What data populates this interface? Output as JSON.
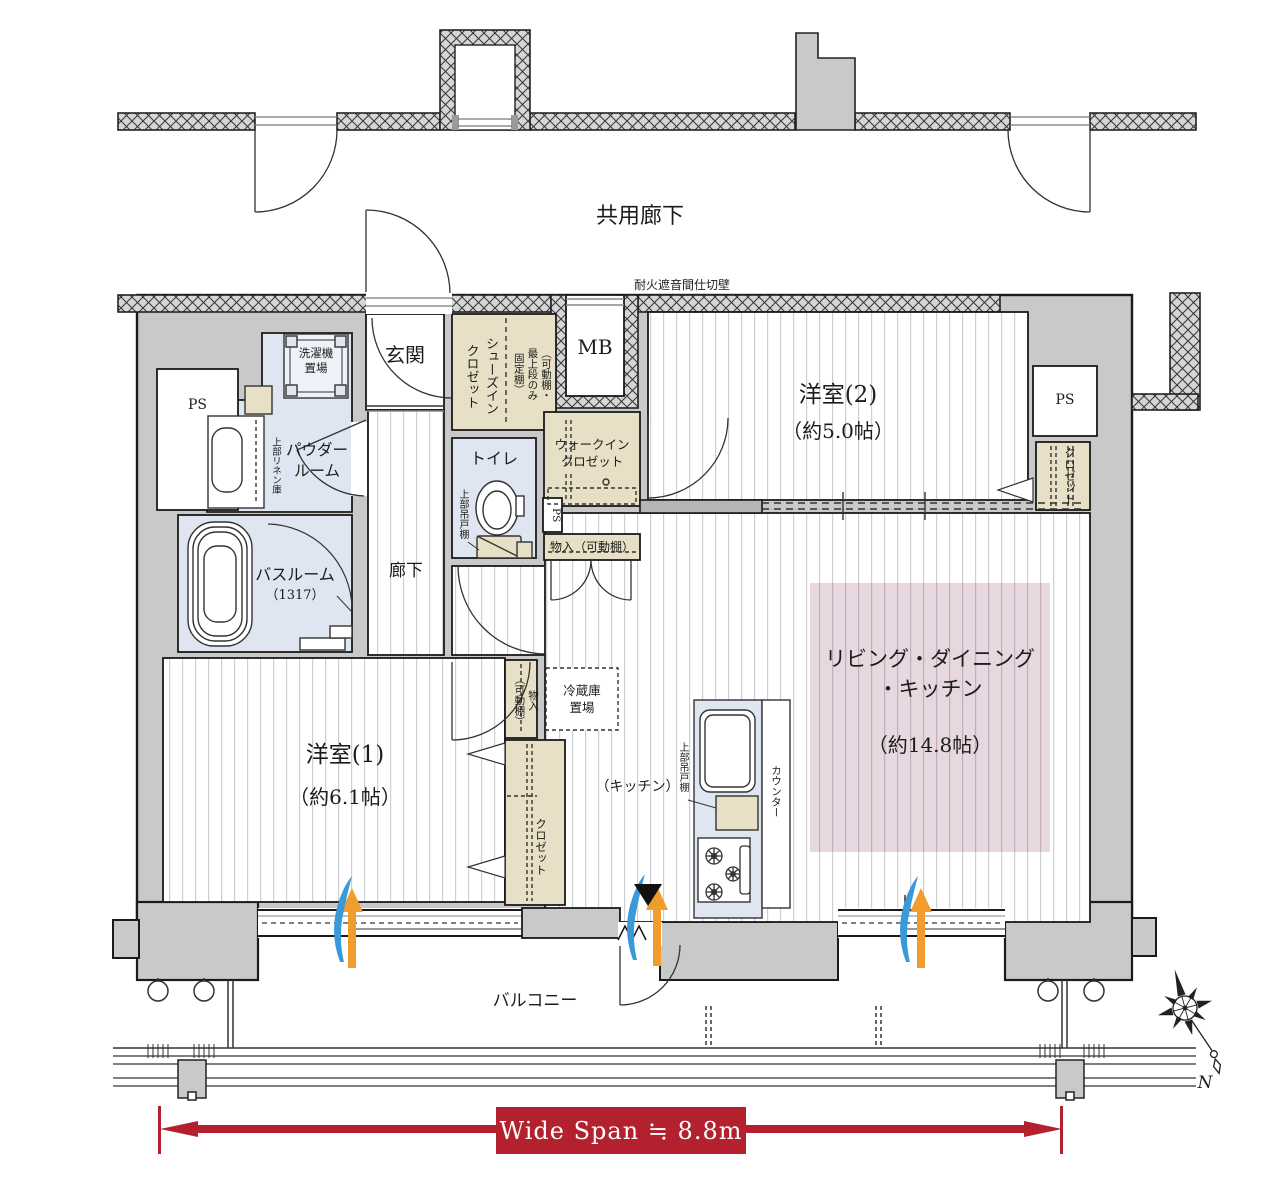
{
  "plan": {
    "labels": {
      "shared_corridor": "共用廊下",
      "firewall": "耐火遮音間仕切壁",
      "meter_box": "MB",
      "entrance": "玄関",
      "shoes_closet": "シューズイン\nクロゼット",
      "shoes_closet_note": "（可動棚・\n最上段のみ\n固定棚）",
      "western_room_2": "洋室(2)",
      "western_room_2_size": "（約5.0帖）",
      "ps": "PS",
      "closet": "クロゼット",
      "walk_in_closet": "ウォークイン\nクロゼット",
      "storage_shelf": "物入（可動棚）",
      "storage_shelf_vertical": "物入\n（可動棚）",
      "toilet": "トイレ",
      "upper_cabinet": "上部吊戸棚",
      "washer_space": "洗濯機\n置場",
      "linen_cabinet": "上部リネン庫",
      "powder_room": "パウダー\nルーム",
      "bathroom": "バスルーム",
      "bathroom_size": "（1317）",
      "hallway": "廊下",
      "western_room_1": "洋室(1)",
      "western_room_1_size": "（約6.1帖）",
      "refrigerator_space": "冷蔵庫\n置場",
      "kitchen": "（キッチン）",
      "counter": "カウンター",
      "ldk": "リビング・ダイニング\n・キッチン",
      "ldk_size": "（約14.8帖）",
      "balcony": "バルコニー",
      "wide_span": "Wide Span ≒ 8.8m",
      "north": "N"
    },
    "colors": {
      "wall_fill": "#c9c9c9",
      "hatch_fill": "#d6d6d6",
      "closet_fill": "#e8e0c6",
      "wet_area_fill": "#dfe6f1",
      "rug_fill": "#e6d8de",
      "dimension_red": "#b3202e",
      "airflow_orange": "#f09d2e",
      "airflow_blue": "#3a9ad9"
    }
  }
}
